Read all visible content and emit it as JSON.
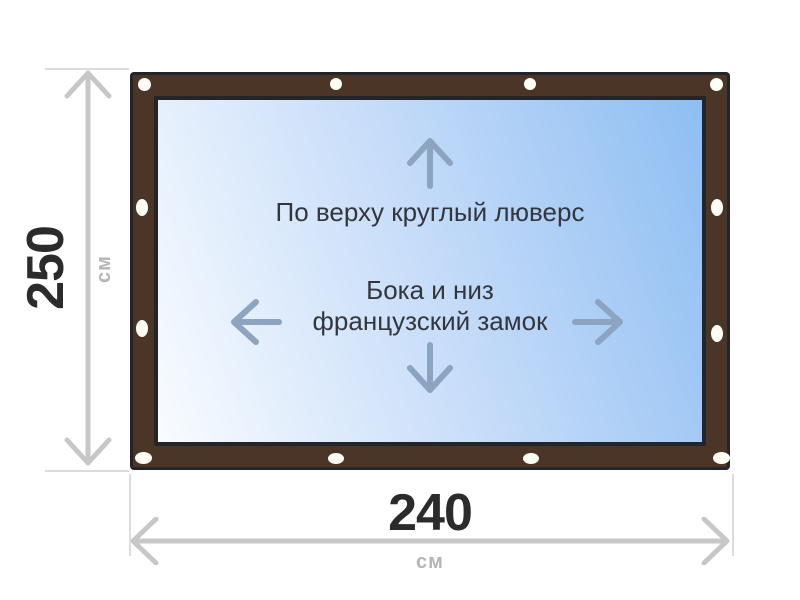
{
  "diagram": {
    "annotation_top": "По верху круглый люверс",
    "annotation_middle": [
      "Бока и низ",
      "французский замок"
    ]
  },
  "dimensions": {
    "height": {
      "value": "250",
      "unit": "см"
    },
    "width": {
      "value": "240",
      "unit": "см"
    }
  },
  "icons": [
    "arrow-up-icon",
    "arrow-down-icon",
    "arrow-left-icon",
    "arrow-right-icon",
    "height-dimension-arrow-icon",
    "width-dimension-arrow-icon"
  ],
  "colors": {
    "frame_brown": "#4a3527",
    "frame_outline": "#232529",
    "fabric_light": "#f9fcff",
    "fabric_blue": "#8ebef2",
    "grommet_white": "#fffdf6",
    "annotation_text": "#33373d",
    "direction_arrow": "#8ca4bf",
    "dimension_arrow": "#c7c7c7",
    "extension_line": "#dcdcdc",
    "dimension_value": "#2b2b2b",
    "dimension_unit": "#b5b5b5"
  }
}
